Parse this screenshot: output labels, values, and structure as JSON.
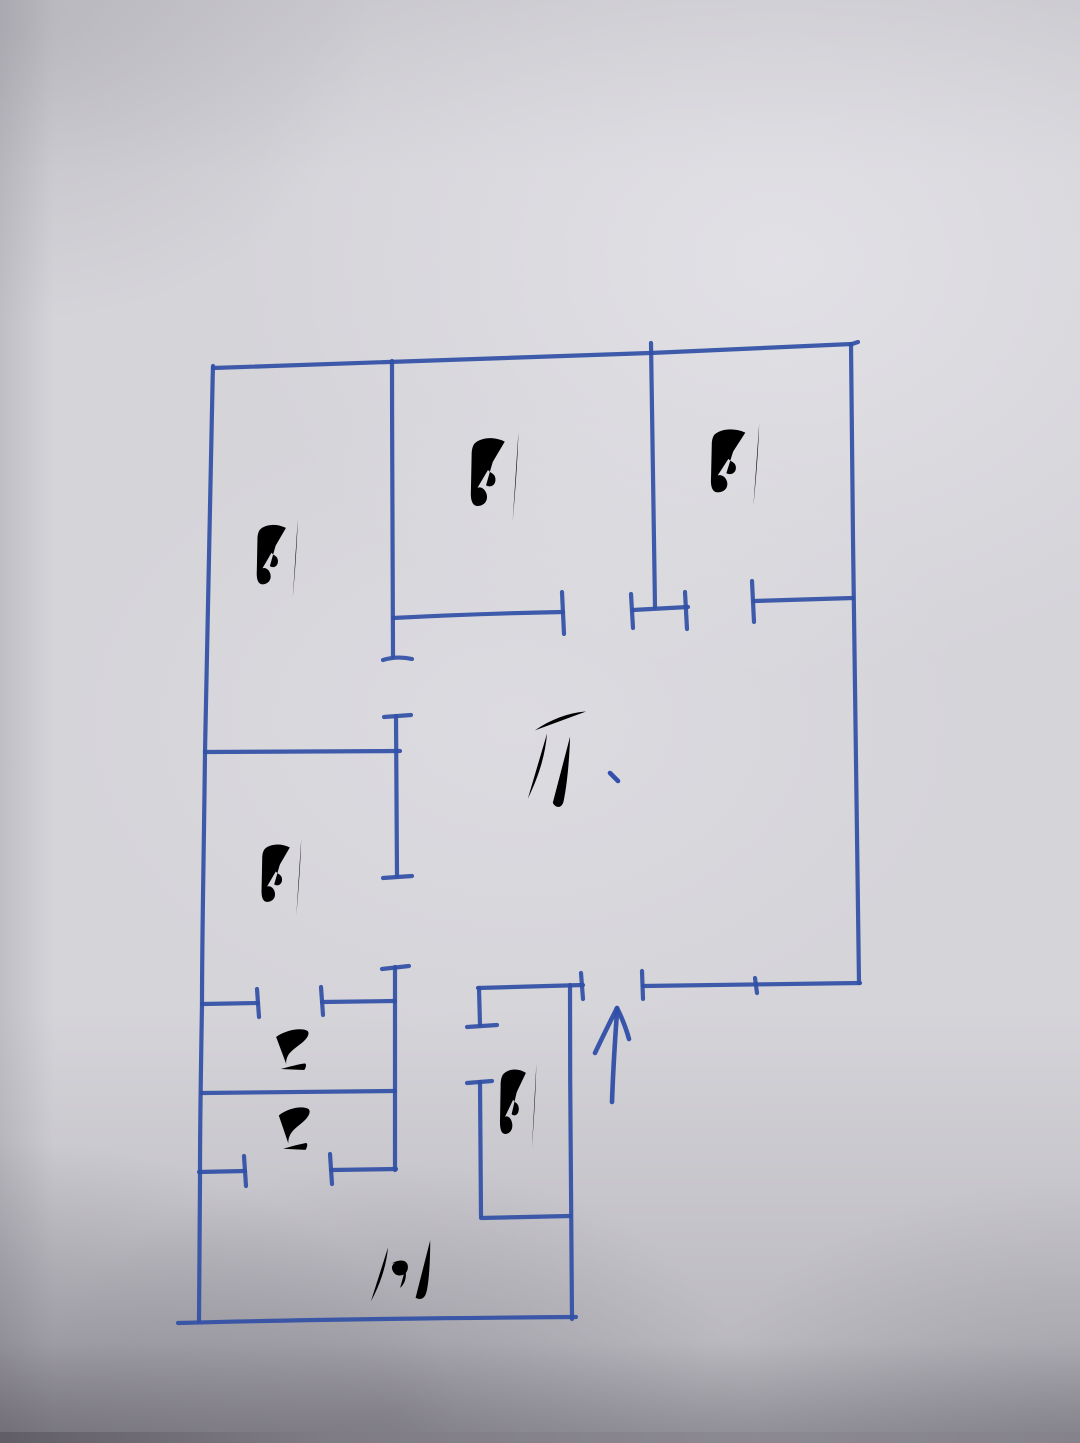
{
  "figure": {
    "kind": "hand-drawn apartment floor plan sketch, blue ballpoint pen on gray paper",
    "ink_color": "#2f50a8",
    "paper_color": "#d5d4d9"
  },
  "rooms": [
    {
      "id": "bedroom-top-left",
      "label": "卧"
    },
    {
      "id": "bedroom-top-middle",
      "label": "卧"
    },
    {
      "id": "bedroom-top-right",
      "label": "卧"
    },
    {
      "id": "bedroom-middle-left",
      "label": "卧"
    },
    {
      "id": "bedroom-entry",
      "label": "卧"
    },
    {
      "id": "living-room",
      "label": "厅"
    },
    {
      "id": "bathroom-upper",
      "label": "卫"
    },
    {
      "id": "bathroom-lower",
      "label": "卫"
    },
    {
      "id": "kitchen",
      "label": "厨"
    }
  ],
  "entrance": {
    "symbol": "entrance-up-arrow"
  }
}
